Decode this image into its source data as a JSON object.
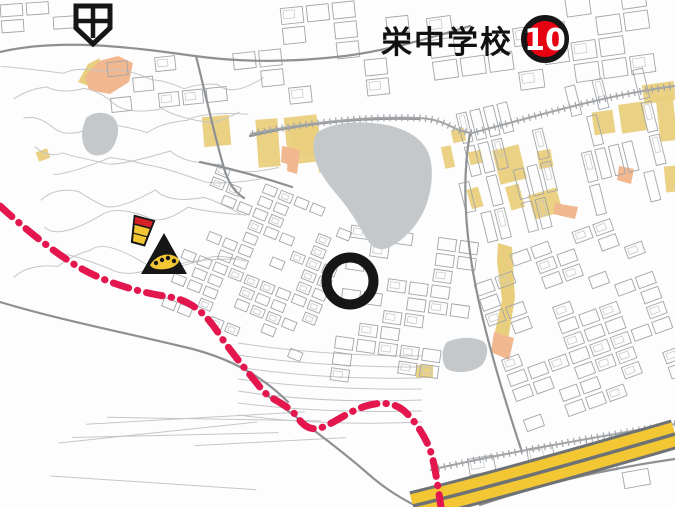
{
  "map": {
    "kind": "japanese-hazard-map",
    "labels": {
      "school": "栄中学校",
      "badge_number": "10"
    },
    "icons": [
      {
        "name": "hospital-icon",
        "x": 93,
        "y": 25
      },
      {
        "name": "landslide-hazard-icon",
        "x": 141,
        "y": 231,
        "rotate": 15
      },
      {
        "name": "debris-flow-hazard-icon",
        "x": 164,
        "y": 259
      },
      {
        "name": "target-circle-marker",
        "x": 350,
        "y": 281,
        "radius": 23.5,
        "stroke_width": 10
      },
      {
        "name": "map-number-badge",
        "x": 545,
        "y": 39,
        "radius": 21
      }
    ],
    "colors": {
      "bg": "#fdfdfe",
      "line_light": "#c3c6c8",
      "line_mid": "#a2a5a8",
      "line_dark": "#8e9194",
      "hazard_yellow": "#e9cf7d",
      "hazard_orange": "#f1b78e",
      "water_gray": "#c5c8cb",
      "boundary_red": "#e3174d",
      "road_yellow": "#f2c733",
      "road_border": "#6e7274",
      "symbol_black": "#161616",
      "badge_red": "#e60012",
      "badge_text": "#ffffff",
      "label_color": "#111111"
    },
    "overlays": {
      "pond": "M318,132 C330,124 352,121 372,123 C398,125 418,134 427,150 C434,163 433,185 427,203 C420,224 404,240 390,247 C380,252 372,248 366,238 C358,224 350,210 338,196 C326,182 316,168 314,154 C313,144 313,138 318,132 Z",
      "gray_blob_left": "M86,118 C94,111 107,111 114,118 C120,125 119,137 113,147 C107,156 95,158 88,152 C82,146 81,135 83,127 Z",
      "gray_blob_right": "M447,342 C457,337 475,336 484,342 C489,347 488,357 482,365 C473,373 455,374 447,369 C441,363 441,349 447,342 Z",
      "yellow_rects": [
        [
          203,
          116,
          27,
          30,
          -5
        ],
        [
          257,
          119,
          22,
          48,
          -4
        ],
        [
          286,
          116,
          33,
          47,
          -6
        ],
        [
          291,
          127,
          28,
          28,
          0
        ],
        [
          318,
          148,
          17,
          24,
          -4
        ],
        [
          443,
          146,
          10,
          22,
          -12
        ],
        [
          452,
          129,
          13,
          13,
          -12
        ],
        [
          469,
          151,
          13,
          13,
          -12
        ],
        [
          496,
          147,
          27,
          35,
          -14
        ],
        [
          508,
          185,
          14,
          24,
          -16
        ],
        [
          531,
          191,
          29,
          25,
          -16
        ],
        [
          469,
          188,
          12,
          20,
          -16
        ],
        [
          593,
          111,
          21,
          23,
          -8
        ],
        [
          620,
          103,
          25,
          29,
          -8
        ],
        [
          643,
          83,
          32,
          19,
          -8
        ],
        [
          658,
          96,
          17,
          45,
          -6
        ],
        [
          416,
          365,
          17,
          13,
          0
        ],
        [
          538,
          150,
          14,
          18,
          -10
        ],
        [
          665,
          166,
          12,
          26,
          -6
        ],
        [
          37,
          150,
          12,
          10,
          -20
        ]
      ],
      "yellow_paths": [
        "M78,82 L88,64 L100,58 L94,88 Z",
        "M498,243 L512,247 L515,298 L508,340 L497,353 L492,345 L502,300 L497,262 Z"
      ],
      "orange_paths": [
        "M85,77 L99,61 L118,56 L133,63 L129,82 L110,94 L89,90 Z",
        "M288,147 L300,150 L297,174 L287,171 Z",
        "M282,146 L292,148 L290,165 L281,162 Z",
        "M619,166 L634,169 L631,184 L617,180 Z",
        "M555,203 L578,207 L575,219 L553,214 Z",
        "M494,332 L514,338 L509,360 L491,352 Z"
      ],
      "roads": [
        "M0,52 C60,38 130,47 195,56 C245,63 295,62 345,56",
        "M196,56 C206,96 214,134 224,168 C228,182 234,192 244,198",
        "M470,133 C462,178 464,228 476,288 C486,338 504,398 522,452",
        "M268,396 C300,420 336,446 366,472 C386,490 404,500 420,508",
        "M0,302 C60,320 122,332 180,346 C236,358 268,382 288,402",
        "M345,56 C390,50 430,38 470,26",
        "M250,136 C300,124 356,117 420,119",
        "M480,505 C560,478 620,467 675,459",
        "M200,162 C232,169 262,177 292,187"
      ],
      "railways": [
        "M250,134 C310,122 370,116 420,118 C448,120 452,131 472,133 C530,118 600,96 675,86",
        "M430,470 C500,454 590,438 675,424"
      ],
      "expressway_axis": "M413,506 C470,492 565,466 675,434",
      "boundary_line": "M0,206 C22,226 46,246 72,263 C100,281 136,292 170,297 C192,301 206,314 219,334 C233,355 249,373 263,391 C273,401 288,404 298,418 C305,428 313,431 323,427 C336,422 349,411 366,406 C379,402 393,402 403,410 C413,418 423,433 429,447 C434,459 437,481 441,507"
    }
  }
}
